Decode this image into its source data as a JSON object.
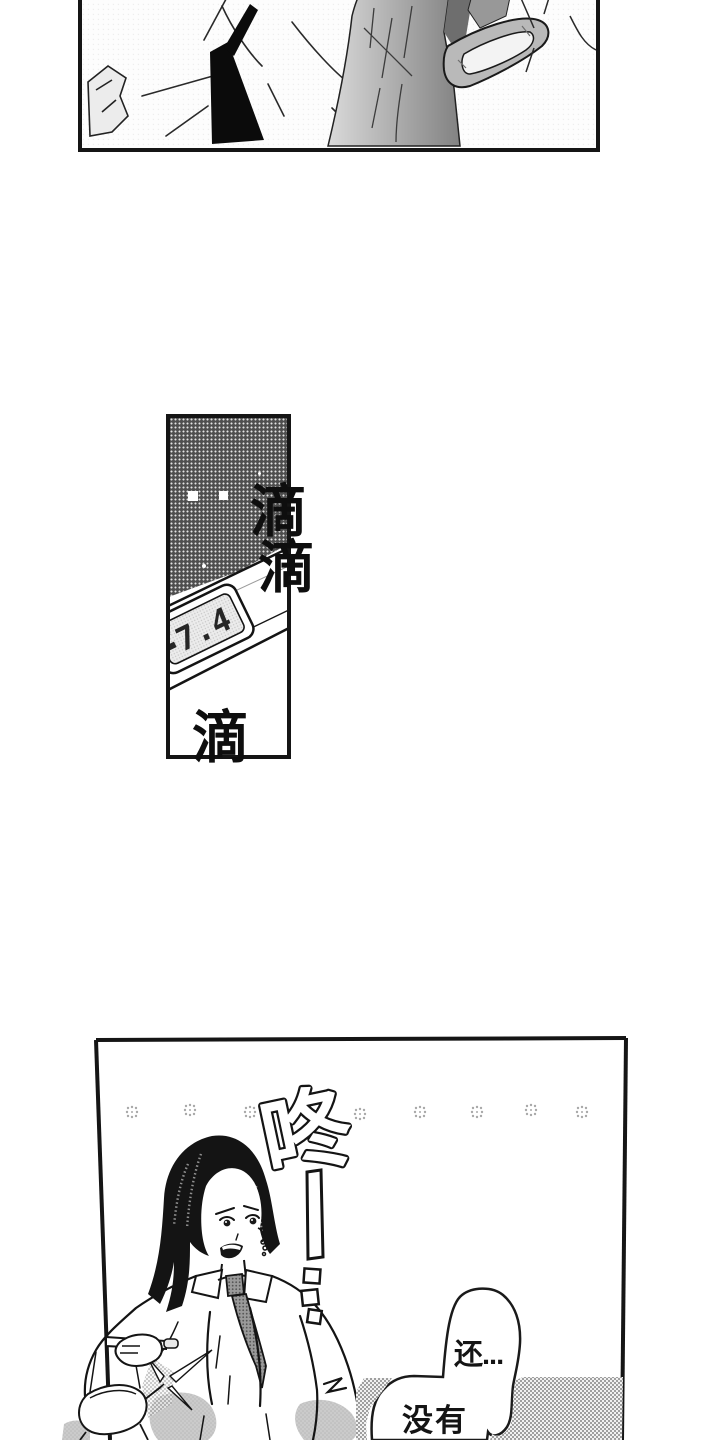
{
  "colors": {
    "ink": "#141414",
    "paper": "#ffffff",
    "halftone_dark": "#4e4e4e",
    "halftone_shadow": "#c9c9c9",
    "halftone_desk": "#9f9f9f"
  },
  "panels": {
    "middle": {
      "thermometer_reading": "7.4",
      "sfx_drip_1": "滴",
      "sfx_drip_2": "滴",
      "sfx_drip_3": "滴"
    },
    "bottom": {
      "sfx_thud": "咚",
      "speech": {
        "line_1": "还...",
        "line_2": "没有"
      }
    }
  }
}
